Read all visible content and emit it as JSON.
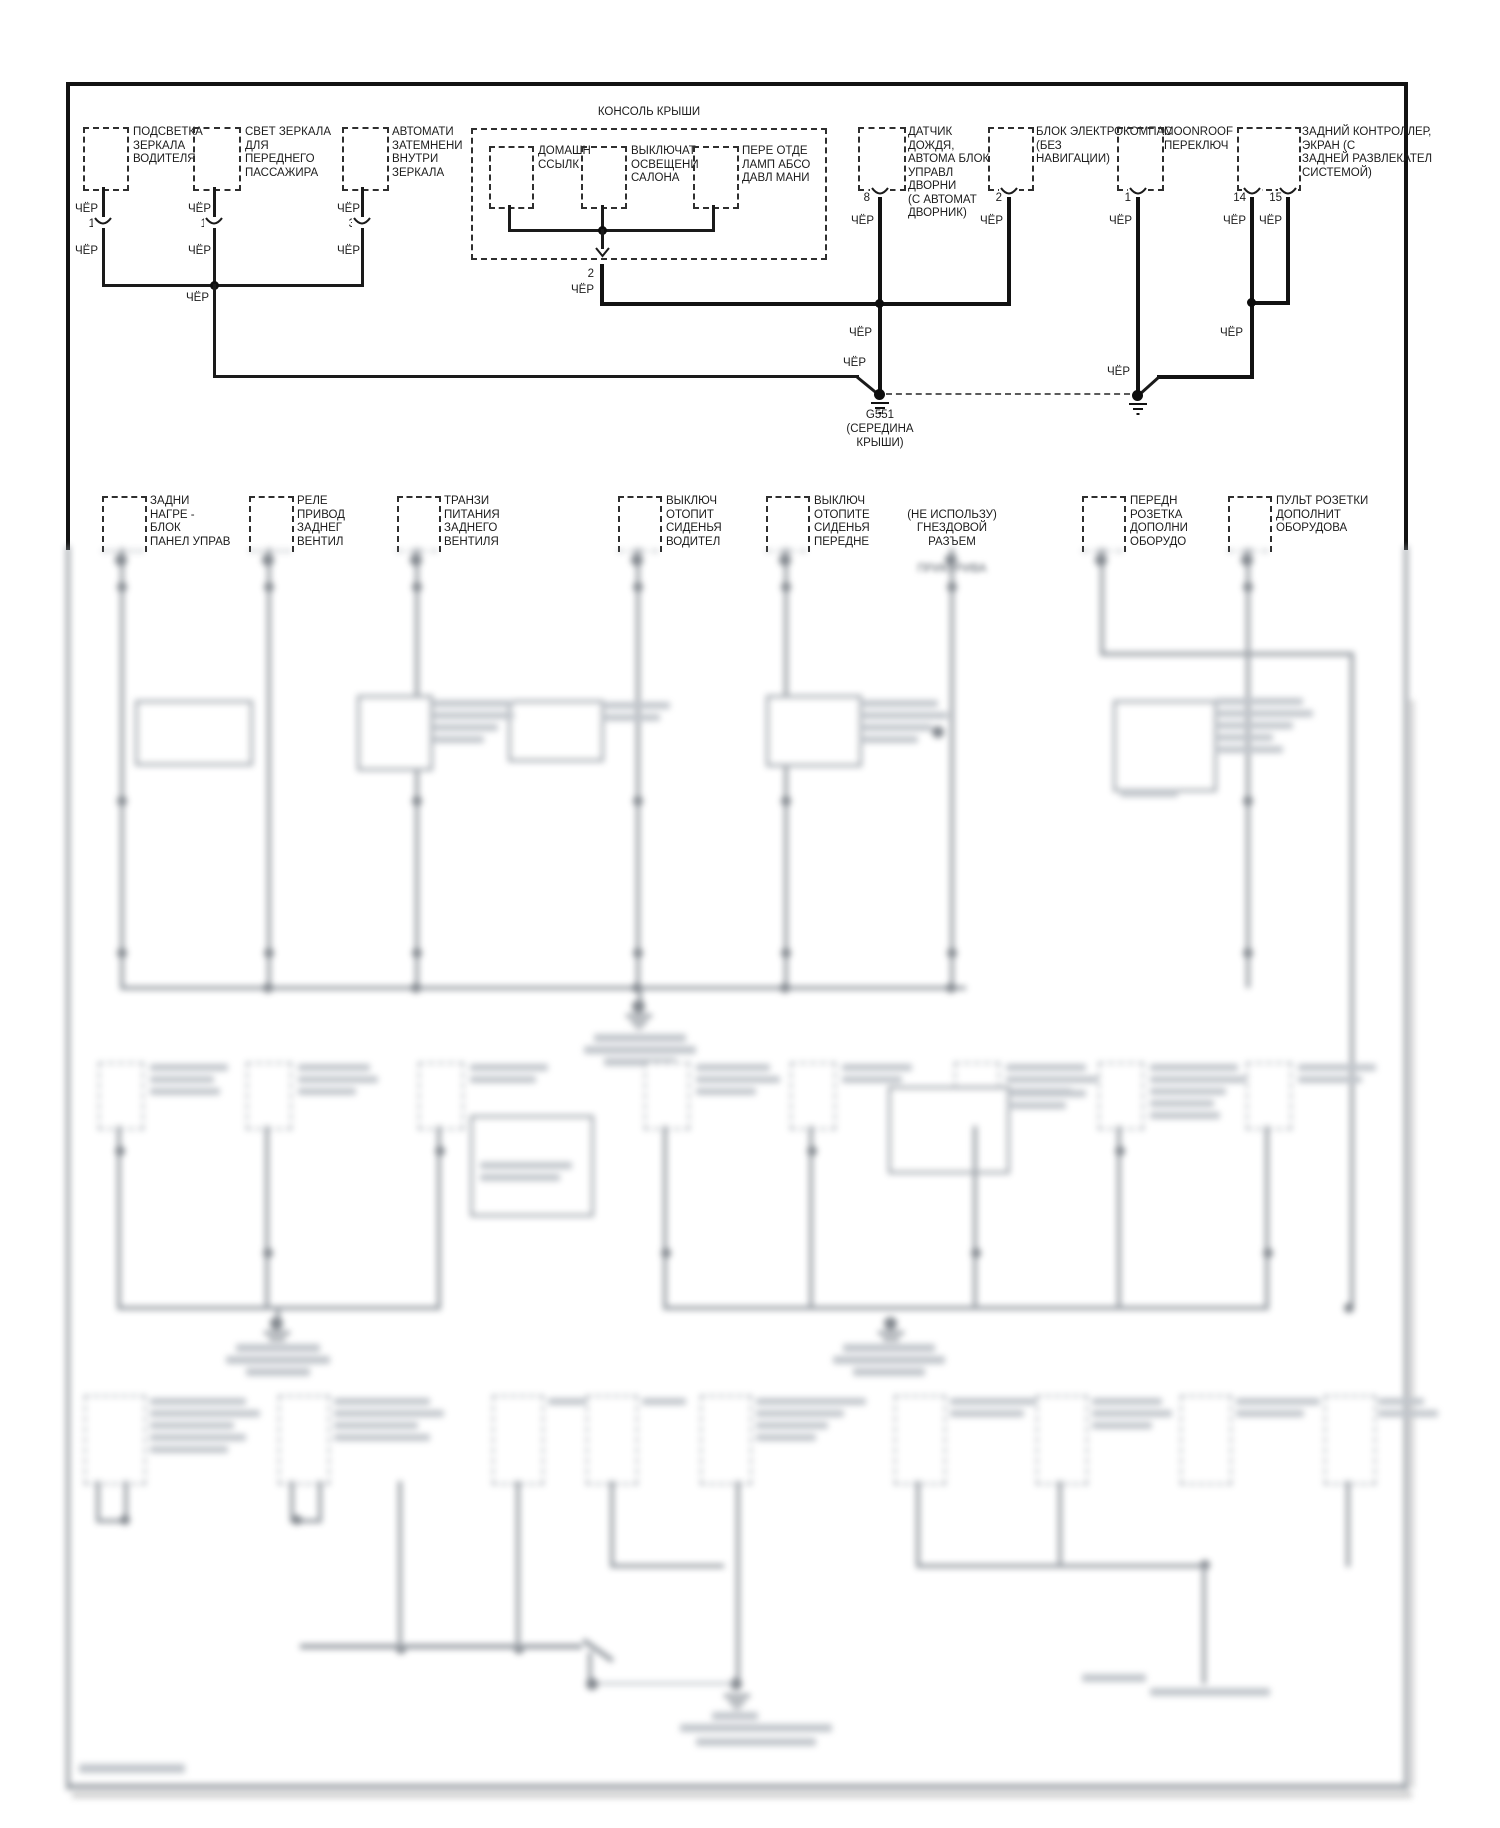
{
  "wire_color": "ЧЁР",
  "top": {
    "console_title": "КОНСОЛЬ КРЫШИ",
    "components": [
      {
        "label": "ПОДСВЕТКА\nЗЕРКАЛА\nВОДИТЕЛЯ",
        "pin": "1"
      },
      {
        "label": "СВЕТ ЗЕРКАЛА\nДЛЯ\nПЕРЕДНЕГО\nПАССАЖИРА",
        "pin": "1"
      },
      {
        "label": "АВТОМАТИ\nЗАТЕМНЕНИ\nВНУТРИ\nЗЕРКАЛА",
        "pin": "3"
      },
      {
        "label": "ДОМАШН\nССЫЛК"
      },
      {
        "label": "ВЫКЛЮЧАТ\nОСВЕЩЕНИ\nСАЛОНА"
      },
      {
        "label": "ПЕРЕ ОТДЕ\nЛАМП АБСО\nДАВЛ МАНИ"
      },
      {
        "label": "ДАТЧИК\nДОЖДЯ,\nАВТОМА БЛОК\nУПРАВЛ\nДВОРНИ\n(С АВТОМАТ\nДВОРНИК)",
        "pin": "8"
      },
      {
        "label": "БЛОК ЭЛЕКТРОКОМПАС\n(БЕЗ\nНАВИГАЦИИ)",
        "pin": "2"
      },
      {
        "label": "MOONROOF\nПЕРЕКЛЮЧ",
        "pin": "1"
      },
      {
        "label": "ЗАДНИЙ КОНТРОЛЛЕР,\nЭКРАН (С\nЗАДНЕЙ РАЗВЛЕКАТЕЛ\nСИСТЕМОЙ)",
        "pin_a": "14",
        "pin_b": "15"
      }
    ],
    "console_pin": "2",
    "ground": {
      "id": "G551",
      "location": "(СЕРЕДИНА\nКРЫШИ)"
    }
  },
  "row2": {
    "components": [
      {
        "label": "ЗАДНИ\nНАГРЕ -\nБЛОК\nПАНЕЛ УПРАВ"
      },
      {
        "label": "РЕЛЕ\nПРИВОД\nЗАДНЕГ\nВЕНТИЛ"
      },
      {
        "label": "ТРАНЗИ\nПИТАНИЯ\nЗАДНЕГО\nВЕНТИЛЯ"
      },
      {
        "label": "ВЫКЛЮЧ\nОТОПИТ\nСИДЕНЬЯ\nВОДИТЕЛ"
      },
      {
        "label": "ВЫКЛЮЧ\nОТОПИТЕ\nСИДЕНЬЯ\nПЕРЕДНЕ"
      },
      {
        "label": "(НЕ ИСПОЛЬЗУ)\nГНЕЗДОВОЙ\nРАЗЪЕМ",
        "label_blurred": "ПРИКУРИВА"
      },
      {
        "label": "ПЕРЕДН\nРОЗЕТКА\nДОПОЛНИ\nОБОРУДО"
      },
      {
        "label": "ПУЛЬТ РОЗЕТКИ\nДОПОЛНИТ\nОБОРУДОВА"
      }
    ]
  }
}
